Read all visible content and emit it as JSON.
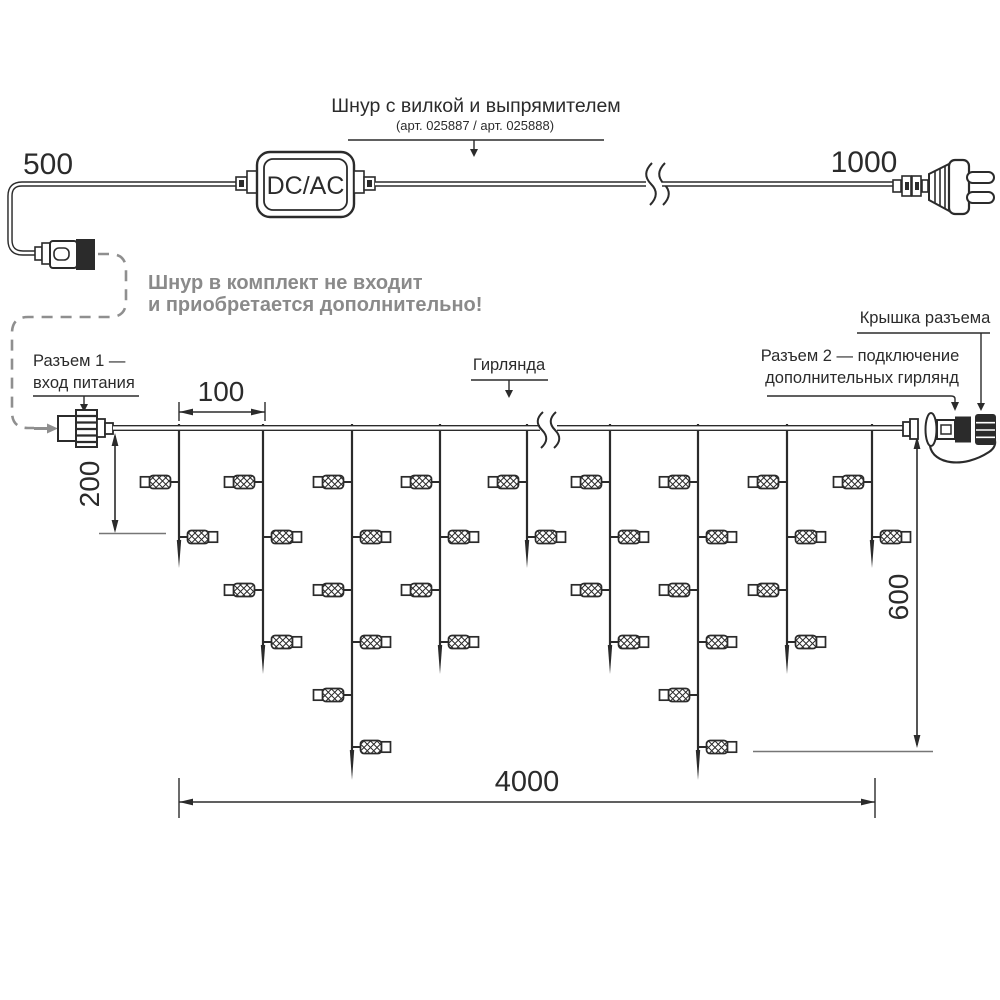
{
  "colors": {
    "line": "#2b2b2b",
    "gray": "#8f8f8f",
    "note": "#8a8a8a",
    "ext": "#767676"
  },
  "top": {
    "cord_label": "Шнур с вилкой и выпрямителем",
    "cord_art": "(арт. 025887 / арт. 025888)",
    "dim_500": "500",
    "dim_1000": "1000",
    "converter": "DC/AC",
    "note1": "Шнур в комплект не входит",
    "note2": "и приобретается дополнительно!"
  },
  "labels": {
    "connector1_l1": "Разъем 1 —",
    "connector1_l2": "вход питания",
    "garland": "Гирлянда",
    "cap": "Крышка разъема",
    "connector2_l1": "Разъем 2 — подключение",
    "connector2_l2": "дополнительных гирлянд"
  },
  "dims": {
    "step": "100",
    "drop_length": "200",
    "height": "600",
    "total_length": "4000"
  },
  "garland": {
    "lamp_levels_y": [
      482,
      537,
      590,
      642,
      695,
      747
    ],
    "drops": [
      {
        "x": 179,
        "lamps": 2
      },
      {
        "x": 263,
        "lamps": 4
      },
      {
        "x": 352,
        "lamps": 6
      },
      {
        "x": 440,
        "lamps": 4
      },
      {
        "x": 527,
        "lamps": 2
      },
      {
        "x": 610,
        "lamps": 4
      },
      {
        "x": 698,
        "lamps": 6
      },
      {
        "x": 787,
        "lamps": 4
      },
      {
        "x": 872,
        "lamps": 2
      }
    ]
  }
}
